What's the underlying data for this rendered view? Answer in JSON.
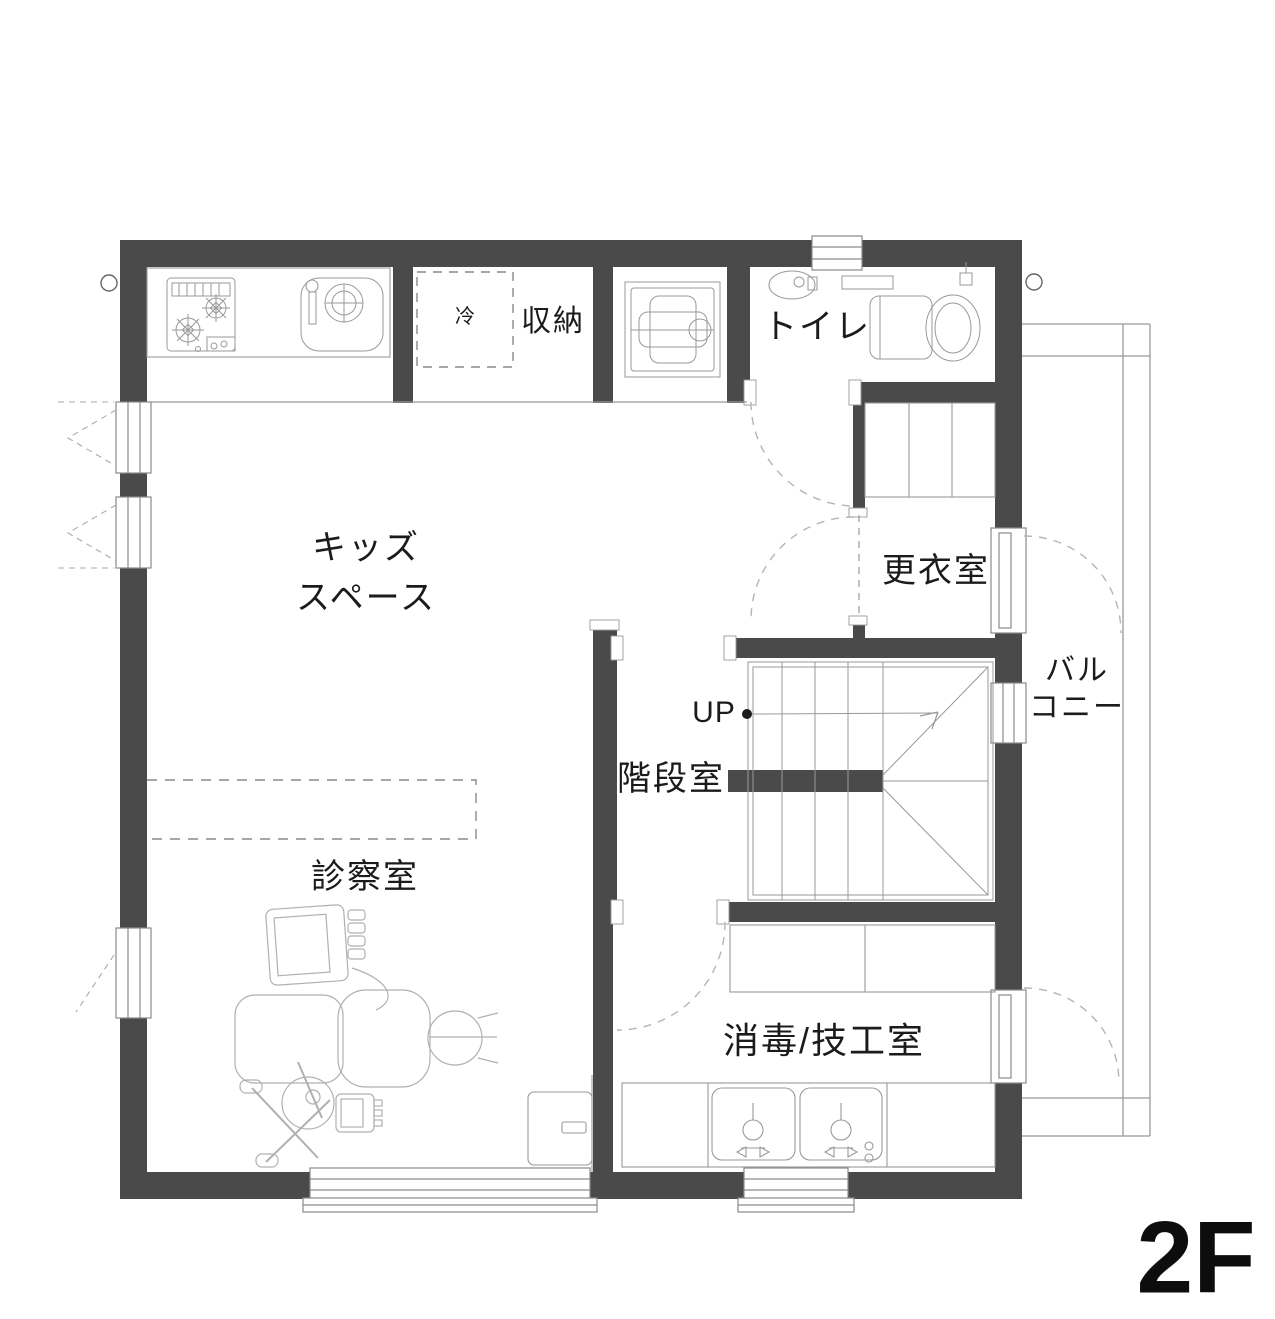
{
  "title": "2F floor plan",
  "floor_label": "2F",
  "labels": {
    "kids_space_line1": "キッズ",
    "kids_space_line2": "スペース",
    "storage": "収納",
    "refrigerator": "冷",
    "toilet": "トイレ",
    "changing_room": "更衣室",
    "balcony_line1": "バル",
    "balcony_line2": "コニー",
    "stair_up": "UP",
    "stairwell": "階段室",
    "exam_room": "診察室",
    "disinfection_lab": "消毒/技工室"
  },
  "colors": {
    "wall": "#4a4a4a",
    "thin_line": "#999999",
    "light_line": "#b5b5b5",
    "text": "#1b1b1b",
    "background": "#ffffff"
  }
}
